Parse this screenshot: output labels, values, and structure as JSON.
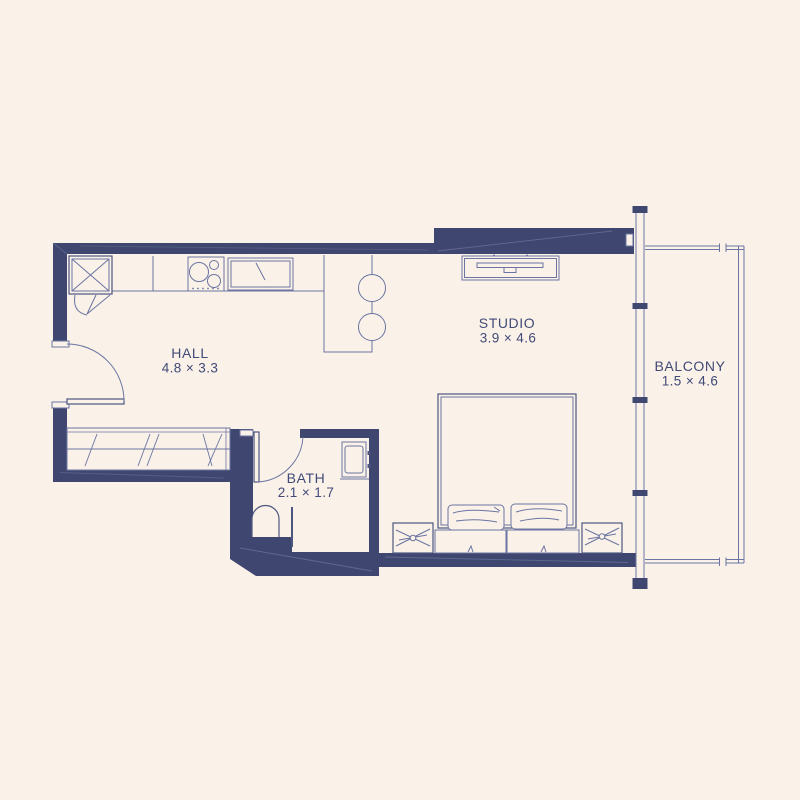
{
  "title": "Studio apartment floor plan",
  "colors": {
    "background": "#faf2e8",
    "wall": "#3f4770",
    "line": "#6b74a2",
    "line_strong": "#4d5680",
    "text": "#414a78"
  },
  "rooms": [
    {
      "id": "hall",
      "name": "HALL",
      "dimensions": "4.8 × 3.3"
    },
    {
      "id": "studio",
      "name": "STUDIO",
      "dimensions": "3.9 × 4.6"
    },
    {
      "id": "bath",
      "name": "BATH",
      "dimensions": "2.1 × 1.7"
    },
    {
      "id": "balcony",
      "name": "BALCONY",
      "dimensions": "1.5 × 4.6"
    }
  ],
  "fixtures": {
    "kitchen": [
      "fridge",
      "counter",
      "stove",
      "sink",
      "bar-counter",
      "stools"
    ],
    "studio": [
      "tv-console",
      "double-bed",
      "pillows",
      "nightstands"
    ],
    "bath": [
      "wash-basin",
      "toilet",
      "partition"
    ],
    "hall": [
      "wardrobe",
      "entrance-door"
    ],
    "facade": [
      "window-wall",
      "balcony-railing"
    ]
  }
}
